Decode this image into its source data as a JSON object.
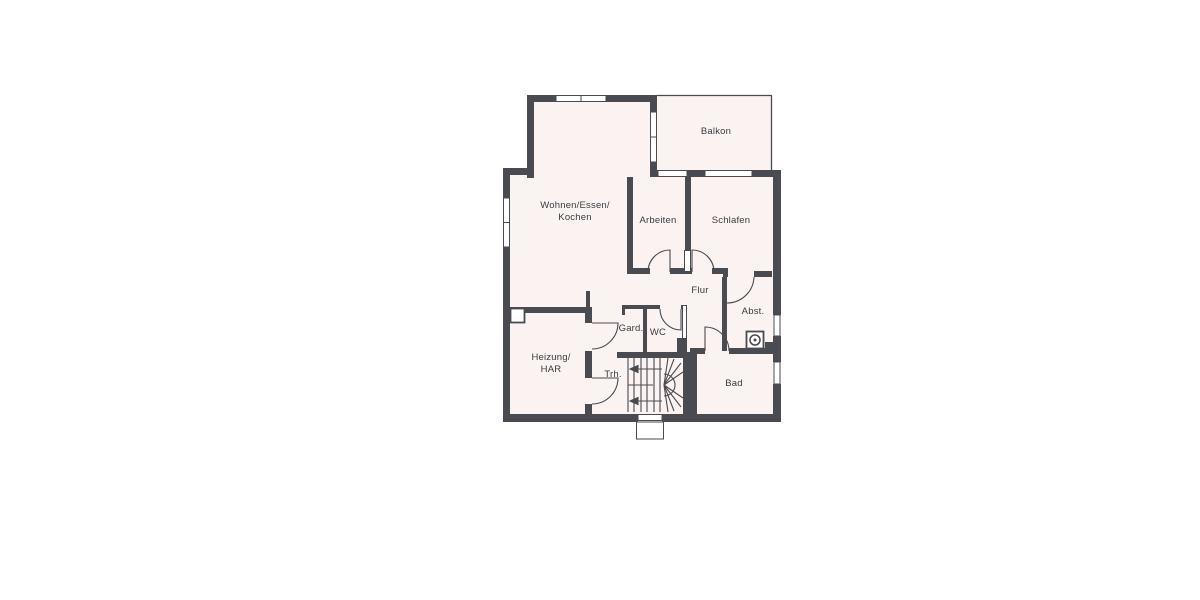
{
  "title": "floor-plan",
  "rooms": {
    "wohnen": {
      "line1": "Wohnen/Essen/",
      "line2": "Kochen"
    },
    "arbeiten": {
      "label": "Arbeiten"
    },
    "schlafen": {
      "label": "Schlafen"
    },
    "balkon": {
      "label": "Balkon"
    },
    "flur": {
      "label": "Flur"
    },
    "abst": {
      "label": "Abst."
    },
    "gard": {
      "label": "Gard."
    },
    "wc": {
      "label": "WC"
    },
    "heizung": {
      "line1": "Heizung/",
      "line2": "HAR"
    },
    "trh": {
      "label": "Trh."
    },
    "bad": {
      "label": "Bad"
    }
  },
  "icons": {
    "washing_machine": "circle-in-square",
    "chimney": "square-outline",
    "entrance_step": "open-rectangle"
  },
  "colors": {
    "wall": "#4a4a51",
    "line": "#4a4a51",
    "room_fill": "#faf3f1",
    "text": "#3b3b40",
    "background": "#ffffff"
  }
}
